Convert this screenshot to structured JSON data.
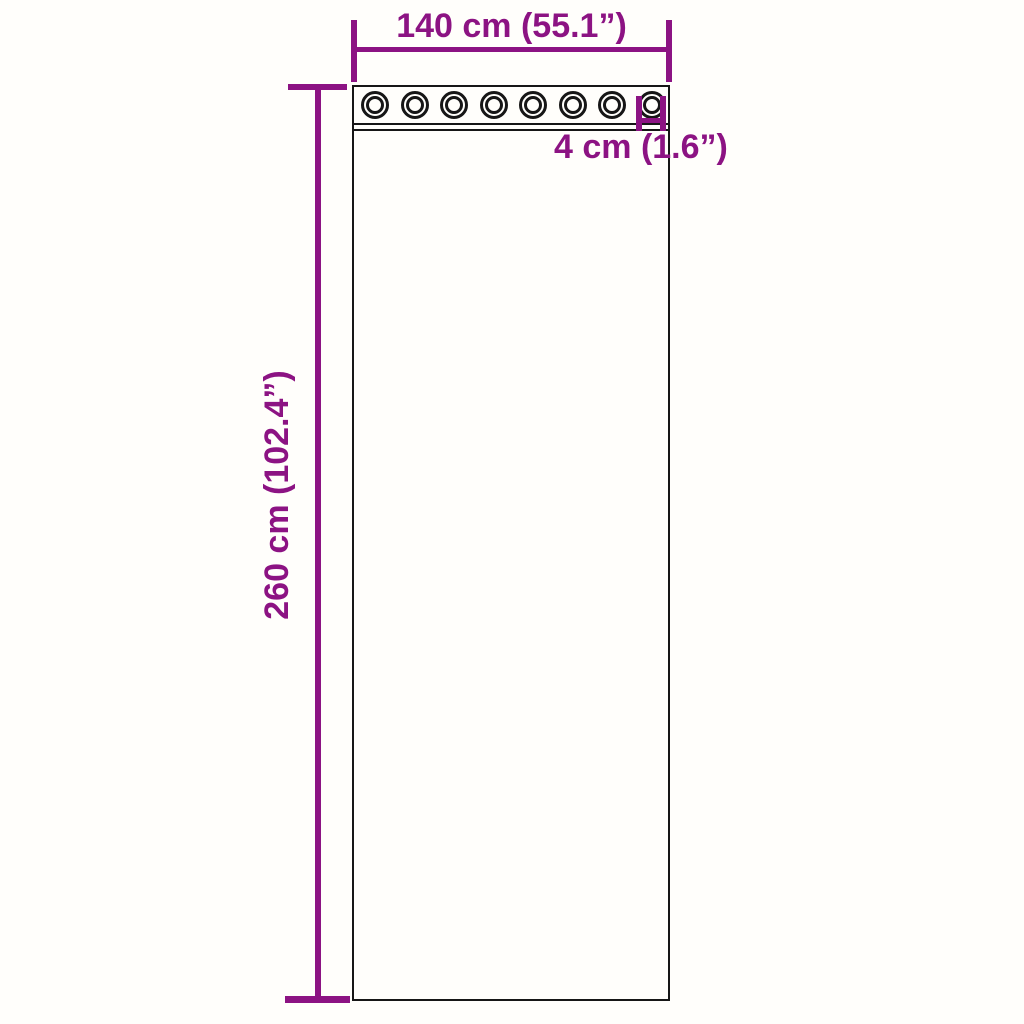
{
  "page": {
    "background_color": "#fffefb"
  },
  "diagram": {
    "outline_color": "#161616",
    "dimension_color": "#8c1383",
    "grommet_count": 8,
    "labels": {
      "width": "140 cm (55.1”)",
      "height": "260 cm (102.4”)",
      "grommet_diameter": "4 cm (1.6”)"
    }
  }
}
